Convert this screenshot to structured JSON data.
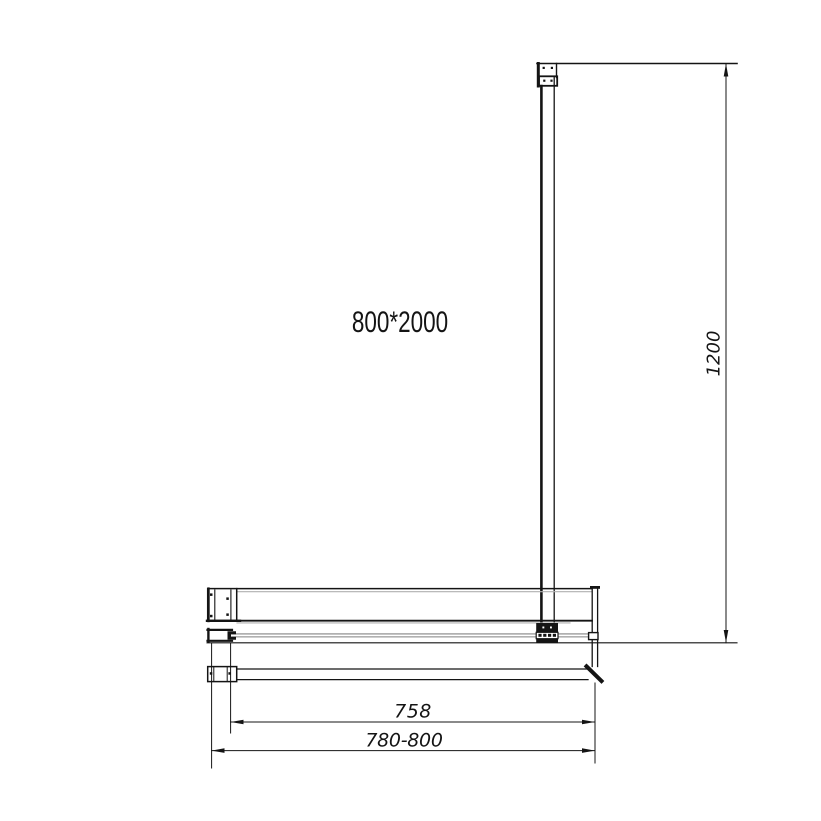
{
  "drawing": {
    "product_label": "800*2000",
    "dimensions": {
      "support_bar_length": "1200",
      "glass_width": "758",
      "adjustable_width": "780-800"
    },
    "colors": {
      "line": "#141414",
      "glass_edge": "#b0b0b0",
      "background": "#ffffff"
    }
  }
}
